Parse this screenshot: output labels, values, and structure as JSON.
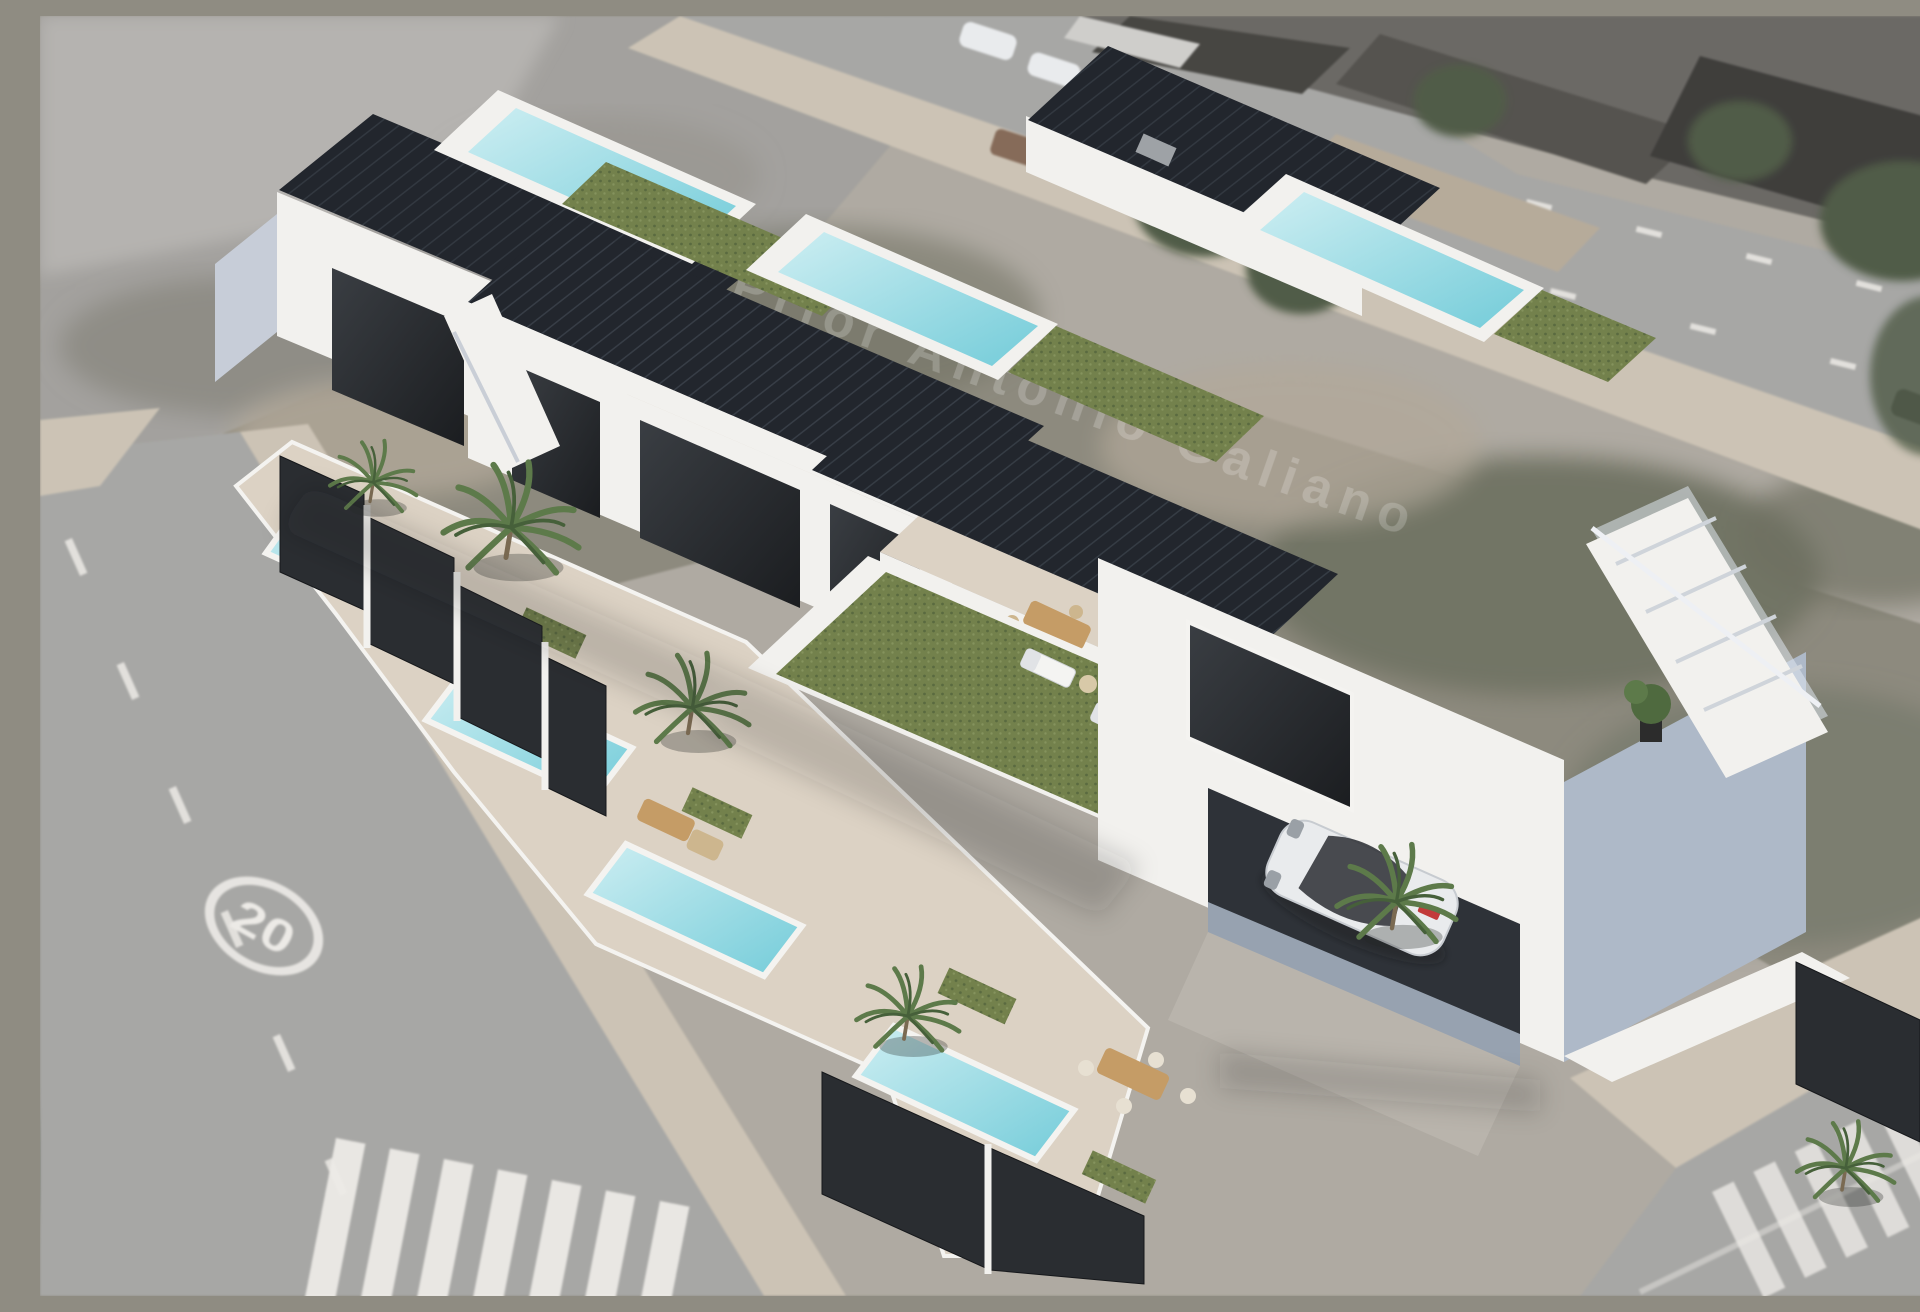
{
  "image": {
    "title": "Aerial composite: 3D render of a modern terraced-villa development placed on an aerial photo of a corner plot",
    "kind": "architectural-render-overlay"
  },
  "texts": {
    "street_watermark": "C. Prior Antonio Galiano",
    "road_speed_marking": "20"
  },
  "scene": {
    "units_count": 4,
    "rooftop_pools": 3,
    "rooftop_garden_lawns": 4,
    "ground_pools": 4,
    "palm_trees": 6,
    "sun_loungers": 2,
    "vehicles": [
      "white coupe parked in open carport",
      "red car behind garden fence",
      "white cars parked along upper road",
      "brown van on upper road kerb",
      "dark vehicle at right road edge"
    ],
    "road_features": [
      "zebra crosswalk bottom-left",
      "zebra crosswalk bottom-right",
      "dashed lane markings on both roads",
      "painted 20 km/h speed-limit circle"
    ],
    "building_features": [
      "black louvred pergola roofs",
      "turquoise rooftop pools with white rims",
      "artificial-grass roof terraces with wooden deck",
      "black slatted garden fences with white posts",
      "exterior staircase at right gable",
      "floor-to-ceiling dark glazing",
      "outdoor dining sets and lounge sofas"
    ]
  },
  "palette": {
    "base-ground": "#b0aaa0",
    "road-gray": "#a7a7a5",
    "sidewalk-beige": "#cdc3b2",
    "scrub-dark": "#6e705f",
    "scrub-mid": "#8e8a7c",
    "scrub-light": "#b3a896",
    "tree-green": "#4f5d45",
    "wall-white": "#f2f1ee",
    "wall-shadow": "#c7cdd8",
    "wall-blue": "#aeb9c8",
    "glass-dark": "#26282b",
    "pergola-dark": "#22262d",
    "pool-roof": "#86d2de",
    "pool-ground": "#8fd8e2",
    "lawn-green": "#73814c",
    "lawn-dark": "#5a6a40",
    "deck-wood": "#c59c66",
    "fence-dark": "#2a2d31",
    "marking-white": "#eceae5",
    "car-white": "#e9ebed",
    "car-red": "#b23434",
    "van-brown": "#8a6a55",
    "terrace-beige": "#dcd2c4"
  }
}
